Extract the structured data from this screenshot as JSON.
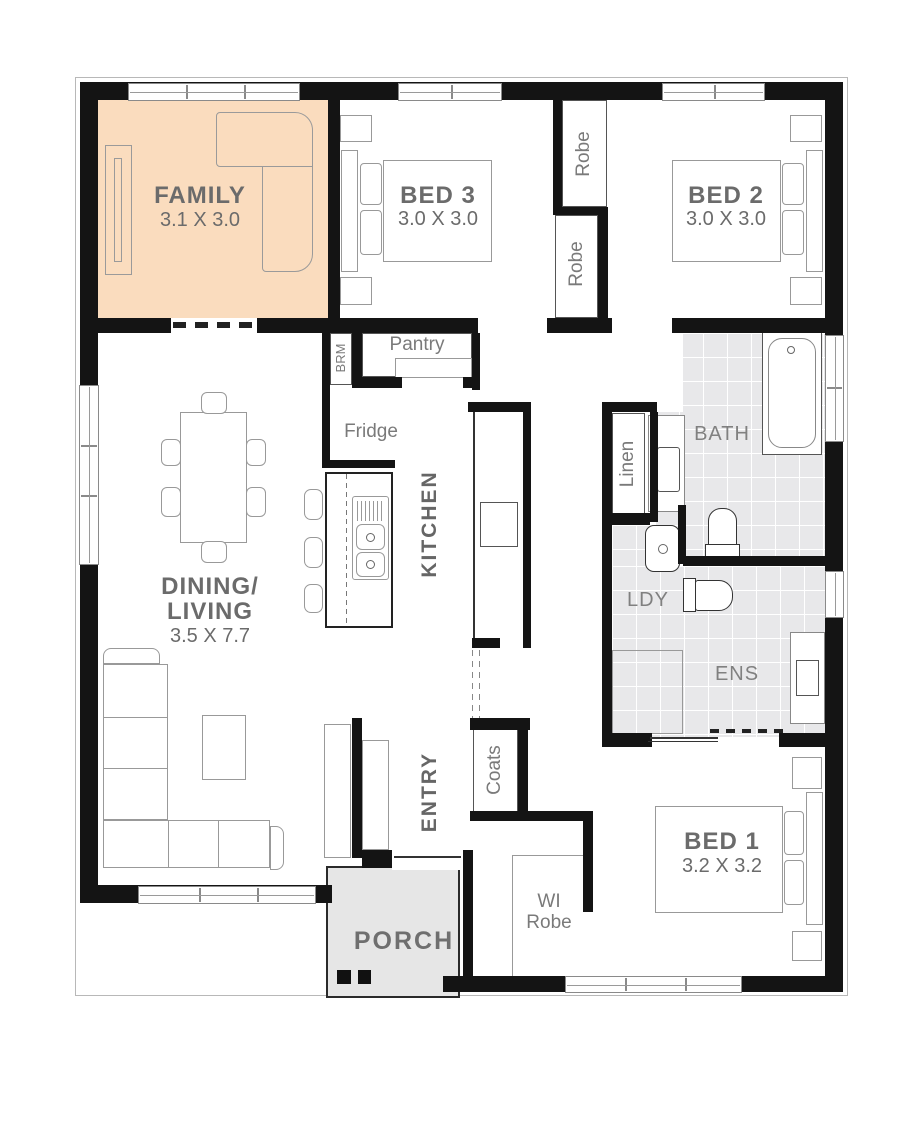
{
  "plan": {
    "colors": {
      "wall": "#141414",
      "highlight": "#fadcbe",
      "tile": "#e8e8ea",
      "porch": "#e6e6e6",
      "label": "#6b6b6b"
    },
    "rooms": {
      "family": {
        "name": "FAMILY",
        "dims": "3.1 X 3.0"
      },
      "bed3": {
        "name": "BED 3",
        "dims": "3.0 X 3.0"
      },
      "bed2": {
        "name": "BED 2",
        "dims": "3.0 X 3.0"
      },
      "bed1": {
        "name": "BED 1",
        "dims": "3.2 X 3.2"
      },
      "dining_living": {
        "name_line1": "DINING/",
        "name_line2": "LIVING",
        "dims": "3.5 X 7.7"
      },
      "kitchen": {
        "name": "KITCHEN"
      },
      "entry": {
        "name": "ENTRY"
      },
      "bath": {
        "name": "BATH"
      },
      "ensuite": {
        "name": "ENS"
      },
      "laundry": {
        "name": "LDY"
      },
      "porch": {
        "name": "PORCH"
      },
      "walk_in_robe": {
        "name_line1": "WI",
        "name_line2": "Robe"
      }
    },
    "closets": {
      "robe_bed2": "Robe",
      "robe_bed3": "Robe",
      "linen": "Linen",
      "coats": "Coats",
      "broom": "BRM",
      "pantry": "Pantry"
    },
    "appliances": {
      "fridge": "Fridge"
    }
  }
}
